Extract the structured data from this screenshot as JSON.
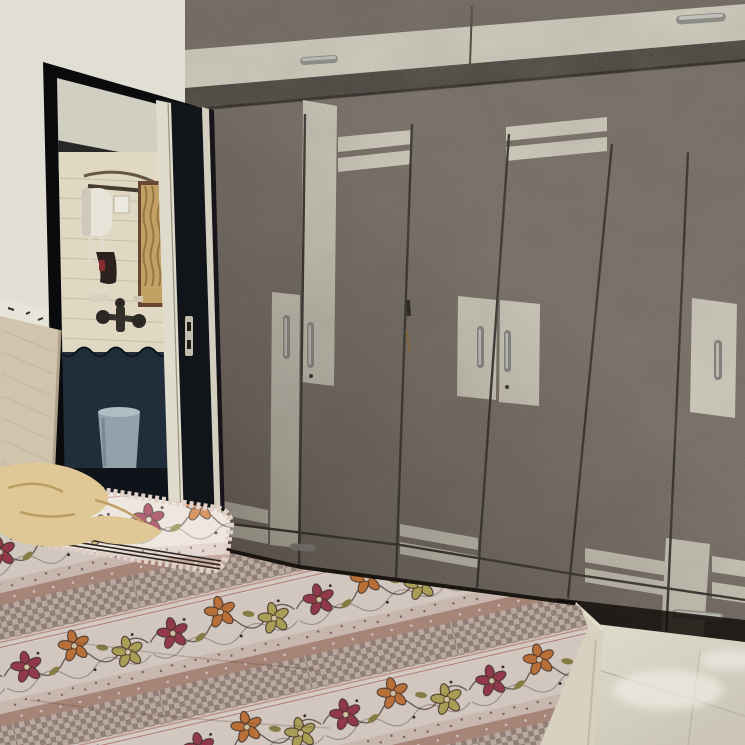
{
  "scene": {
    "title": "Bedroom photo with wardrobe, bathroom doorway and floral bed",
    "objects": {
      "wall": "Cream wall",
      "loft": "Loft cabinets with metal handles",
      "wardrobe": "Grey concrete-finish wardrobe with cream accent stripes",
      "doorway": "Open doorway to bathroom",
      "bathroom": "Bathroom with white tiles and dark blue wainscot",
      "geyser": "White water heater",
      "window": "Fluted glass window",
      "mixer": "Shower mixer tap",
      "bucket": "Blue-grey bucket",
      "door": "Open dark door with latch plate",
      "headboard": "Beige fabric headboard",
      "cloth": "Beige cloth on bed",
      "pillow": "Pillow with frilled edge",
      "bed": "Bed with floral printed sheet",
      "bedbox": "Bed base side panel",
      "floor": "Glossy cream floor tiles"
    }
  },
  "palette": {
    "wall": "#e9e6da",
    "wallShadow": "#d6d2c4",
    "loftGray": "#6f6760",
    "wardrobeGray": "#766d65",
    "ledge": "#46413a",
    "accentCream": "#d8d4c4",
    "seam": "#2f2b26",
    "doorBlack": "#0b0c0e",
    "doorEdgeCream": "#e8e4d4",
    "bathWallUpper": "#d8d6c9",
    "bathTile": "#e9dfca",
    "bathDark": "#232f3d",
    "bathFloor": "#10151c",
    "windowGold": "#caa768",
    "geyserWhite": "#f0ece2",
    "bucketBlue": "#97a7b0",
    "metal": "#a8a8a2",
    "headboard": "#d8cbb3",
    "cloth": "#e7cf9a",
    "sheetBase": "#f4ebe2",
    "checkBrown": "#a5948a",
    "flowerMaroon": "#a63e56",
    "flowerOrange": "#d6813f",
    "flowerYellow": "#c3ba62",
    "swirlDark": "#4a3a33",
    "bedBox": "#e0d8c6",
    "floor": "#ddd9c9",
    "shadow": "#15100c"
  }
}
